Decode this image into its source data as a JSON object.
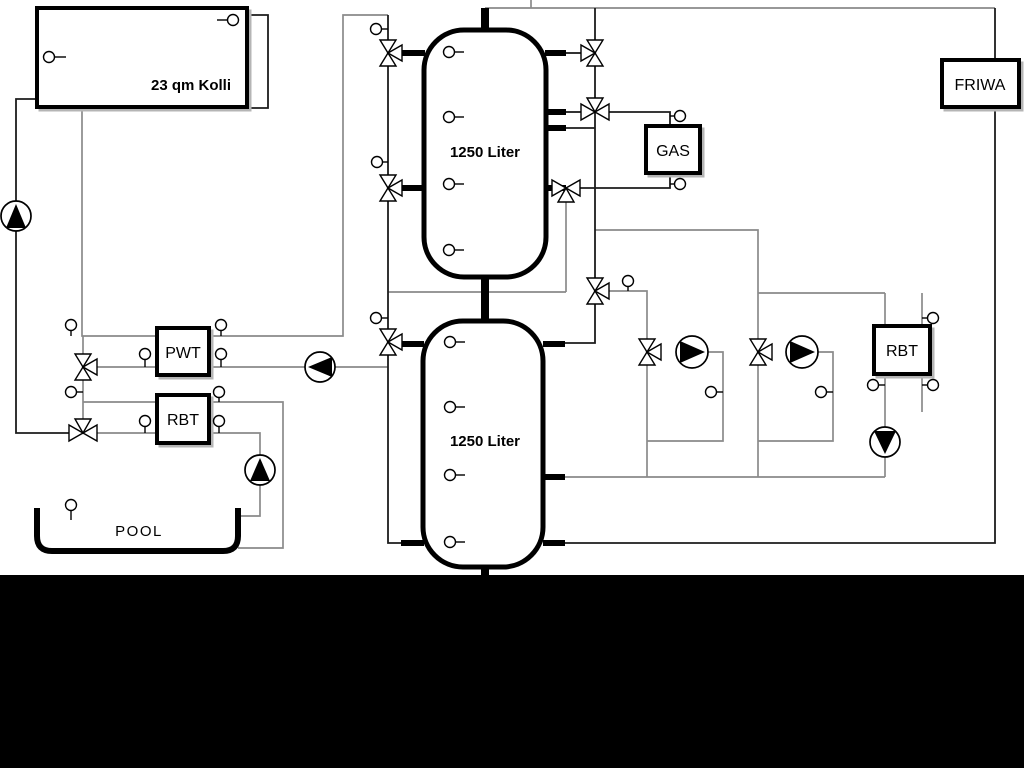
{
  "diagram": {
    "type": "hydraulic-schematic",
    "labels": {
      "collector": "23 qm Kolli",
      "tank_top": "1250 Liter",
      "tank_bottom": "1250 Liter",
      "pwt": "PWT",
      "rbt_pool": "RBT",
      "gas": "GAS",
      "friwa": "FRIWA",
      "rbt_right": "RBT",
      "pool": "POOL"
    },
    "colors": {
      "background": "#ffffff",
      "footer_bar": "#000000",
      "pipe_gray": "#8a8a8a",
      "pipe_dark": "#1c1c1c",
      "component_stroke": "#000000",
      "component_fill": "#ffffff"
    },
    "icons": {
      "pump": "circle-with-solid-triangle",
      "valve": "three-way-bowtie-triangles",
      "sensor": "small-circle-with-stem"
    },
    "counts": {
      "pumps": 6,
      "three_way_valves": 11,
      "sensors": 30
    }
  }
}
